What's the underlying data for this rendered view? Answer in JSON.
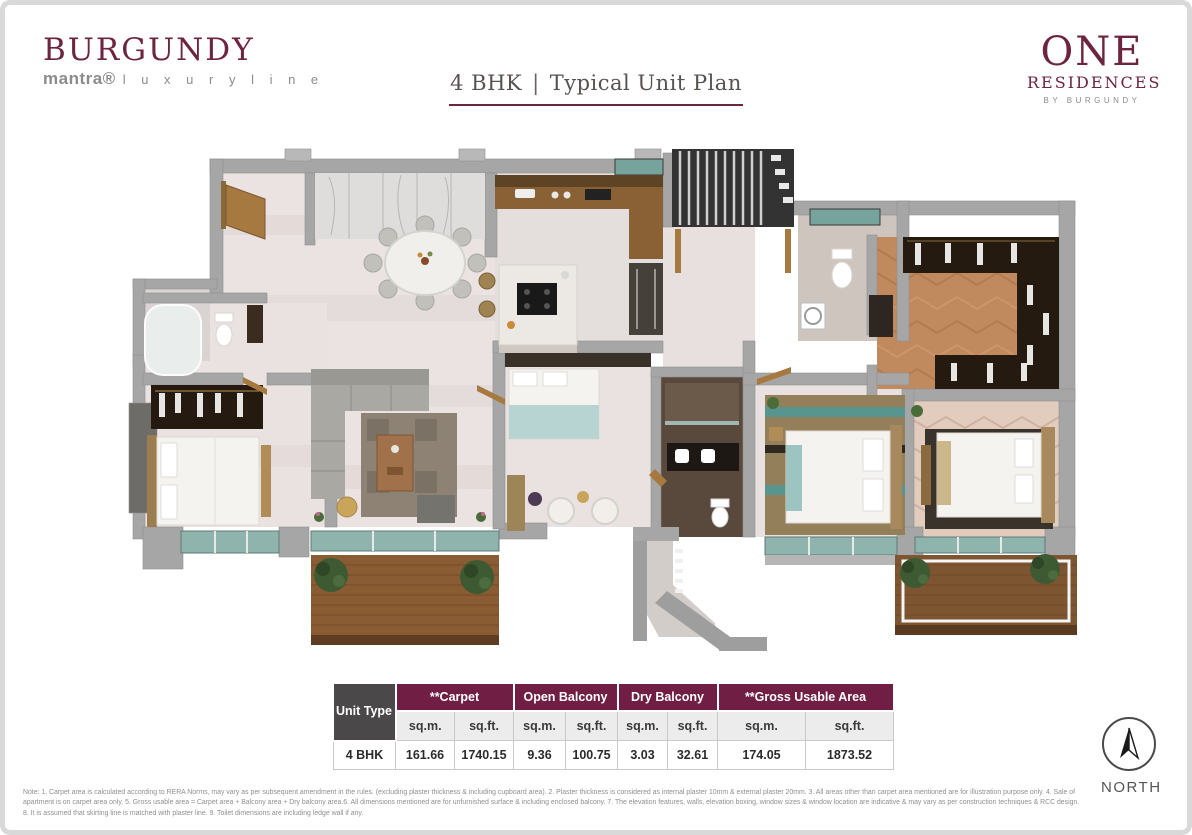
{
  "brand_left": {
    "title": "BURGUNDY",
    "sub_brand": "mantra®",
    "sub_tagline": "l u x u r y   l i n e"
  },
  "header": {
    "unit": "4 BHK",
    "separator": "|",
    "label": "Typical Unit Plan"
  },
  "brand_right": {
    "line1": "ONE",
    "line2": "RESIDENCES",
    "line3": "BY BURGUNDY"
  },
  "area_table": {
    "corner_header": "Unit Type",
    "groups": [
      {
        "label": "**Carpet"
      },
      {
        "label": "Open Balcony"
      },
      {
        "label": "Dry Balcony"
      },
      {
        "label": "**Gross Usable Area"
      }
    ],
    "unit_headers": [
      "sq.m.",
      "sq.ft.",
      "sq.m.",
      "sq.ft.",
      "sq.m.",
      "sq.ft.",
      "sq.m.",
      "sq.ft."
    ],
    "rows": [
      {
        "unit_type": "4 BHK",
        "values": [
          "161.66",
          "1740.15",
          "9.36",
          "100.75",
          "3.03",
          "32.61",
          "174.05",
          "1873.52"
        ]
      }
    ]
  },
  "compass": {
    "label": "NORTH"
  },
  "footnote": "Note: 1. Carpet area is calculated according to RERA Norms, may vary as per subsequent amendment in the rules. (excluding plaster thickness & including cupboard area). 2. Plaster thickness is considered as internal plaster 10mm & external plaster 20mm. 3. All areas other than carpet area mentioned are for illustration purpose only. 4. Sale of apartment is on carpet area only. 5. Gross usable area = Carpet area + Balcony area + Dry balcony area.6. All dimensions mentioned are for unfurnished surface & including enclosed balcony. 7. The elevation features, walls, elevation boxing, window sizes & window location are indicative & may vary as per construction techniques & RCC design. 8. It is assumed that skirting line is matched with plaster line. 9. Toilet dimensions are including ledge wall if any.",
  "colors": {
    "burgundy": "#6d2440",
    "table_header": "#701e44",
    "table_corner": "#4a4848",
    "wall_gray": "#a6a6a6",
    "glass_teal": "#8fb3ad",
    "deck_wood": "#8a5c33",
    "closet_wood": "#c08a5e"
  }
}
